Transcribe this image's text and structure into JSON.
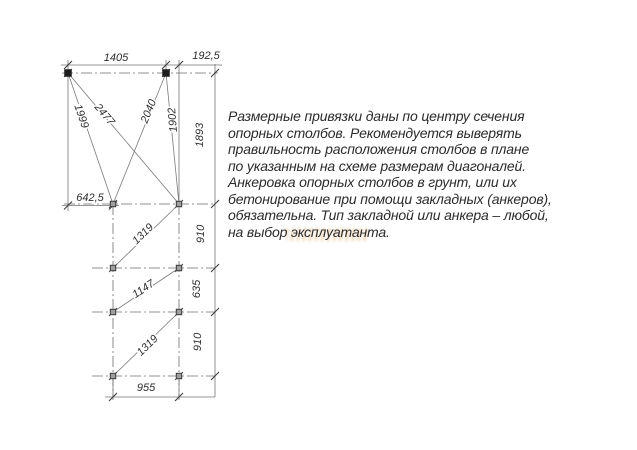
{
  "drawing": {
    "dimensions": {
      "top_span": "1405",
      "right_offset": "192,5",
      "left_offset": "642,5",
      "bottom_span": "955",
      "row1_height": "1893",
      "row2_height": "910",
      "row3_height": "635",
      "row4_height": "910"
    },
    "diagonals": {
      "d1": "1999",
      "d2": "2477",
      "d3": "2040",
      "d4": "1902",
      "d5": "1319",
      "d6": "1147",
      "d7": "1319"
    }
  },
  "note": {
    "lines": [
      "Размерные привязки даны по центру сечения",
      "опорных столбов. Рекомендуется выверять",
      "правильность расположения столбов в плане",
      "по указанным на схеме размерам диагоналей.",
      "Анкеровка опорных столбов в грунт, или их",
      "бетонирование при помощи закладных (анкеров),",
      "обязательна. Тип закладной или анкера – любой,",
      "на выбор эксплуатанта."
    ]
  },
  "watermark": {
    "color": "#d4923f"
  }
}
